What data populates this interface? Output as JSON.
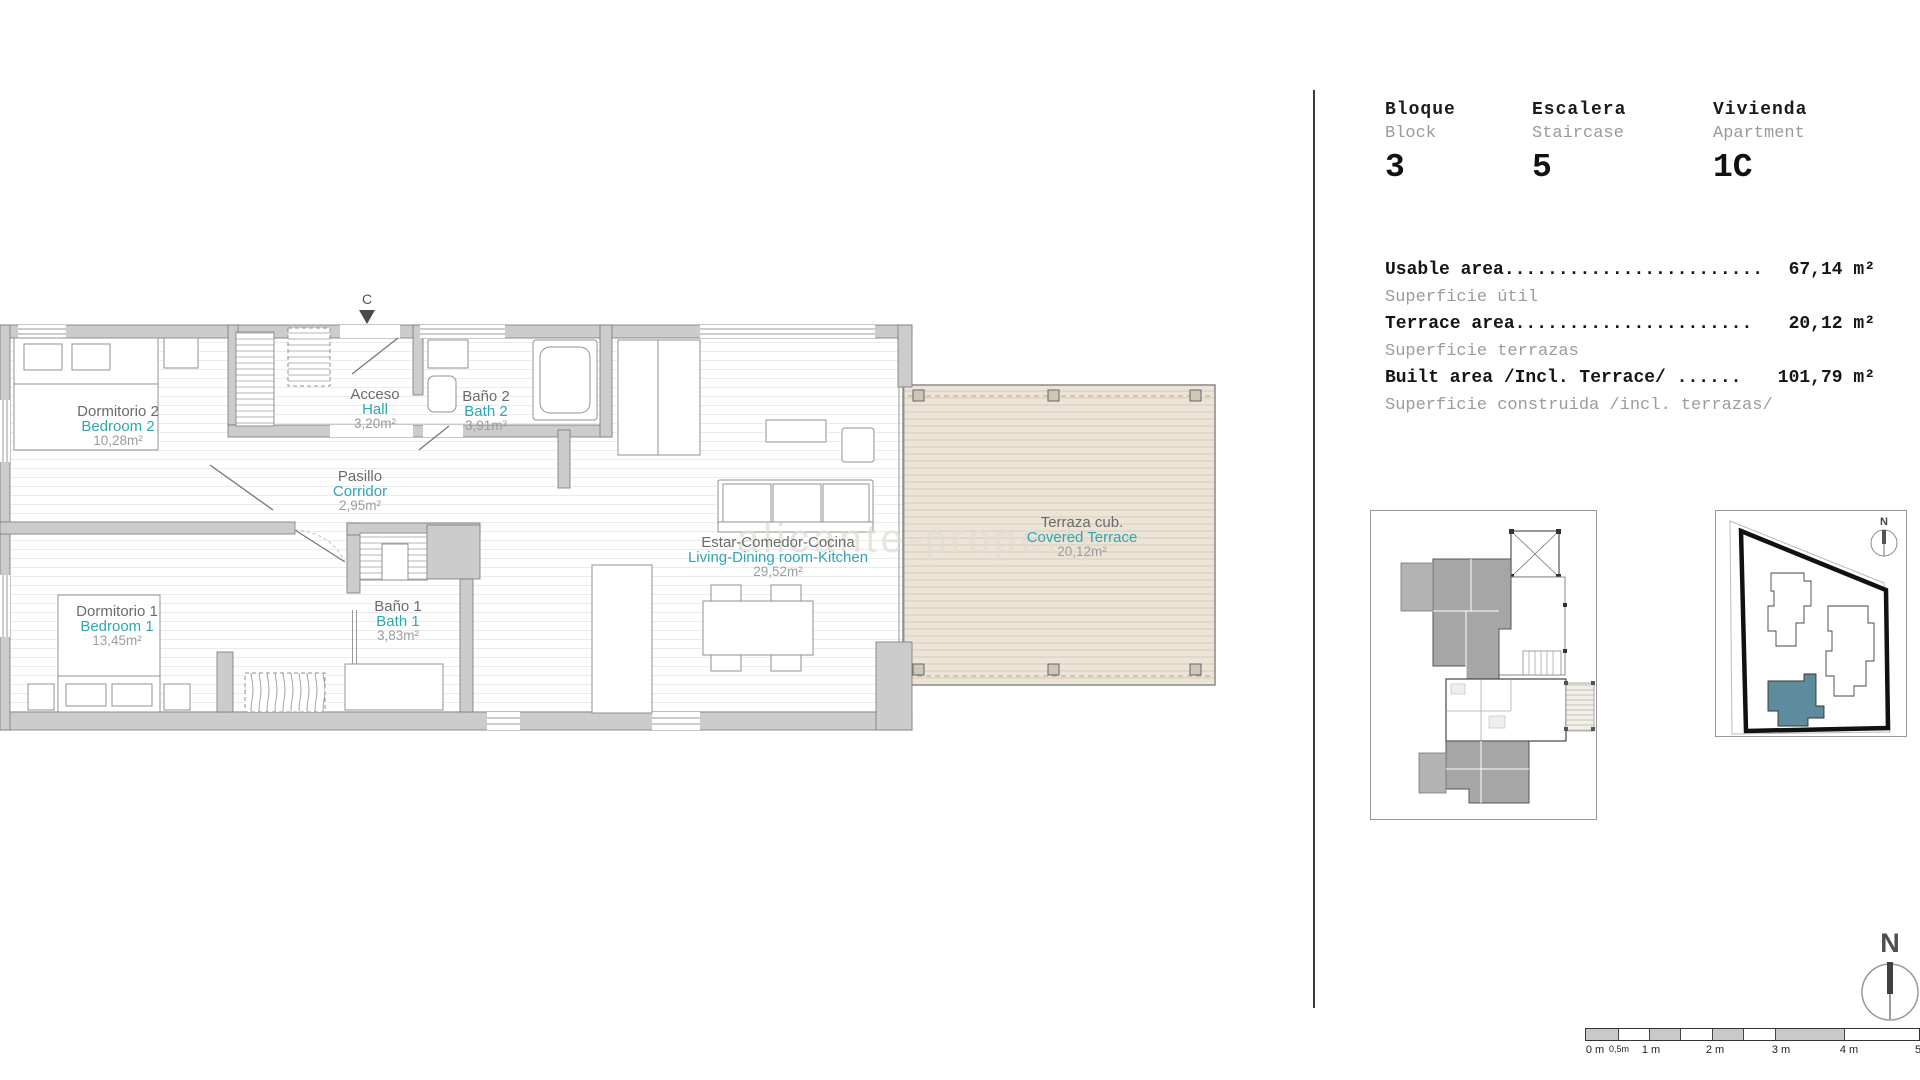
{
  "info_panel": {
    "columns": [
      {
        "es": "Bloque",
        "en": "Block",
        "value": "3"
      },
      {
        "es": "Escalera",
        "en": "Staircase",
        "value": "5"
      },
      {
        "es": "Vivienda",
        "en": "Apartment",
        "value": "1C"
      }
    ],
    "areas": [
      {
        "label": "Usable area",
        "dots": "........................",
        "value": "67,14 m²",
        "sub": "Superficie útil"
      },
      {
        "label": "Terrace area",
        "dots": "......................",
        "value": "20,12 m²",
        "sub": "Superficie terrazas"
      },
      {
        "label": "Built area /Incl. Terrace/ ",
        "dots": "......",
        "value": "101,79 m²",
        "sub": "Superficie construida /incl. terrazas/"
      }
    ]
  },
  "floor_plan": {
    "section_marker": "C",
    "watermark": "alicante-property",
    "rooms": [
      {
        "es": "Dormitorio 2",
        "en": "Bedroom 2",
        "area": "10,28m²"
      },
      {
        "es": "Acceso",
        "en": "Hall",
        "area": "3,20m²"
      },
      {
        "es": "Baño 2",
        "en": "Bath 2",
        "area": "3,91m²"
      },
      {
        "es": "Pasillo",
        "en": "Corridor",
        "area": "2,95m²"
      },
      {
        "es": "Dormitorio 1",
        "en": "Bedroom 1",
        "area": "13,45m²"
      },
      {
        "es": "Baño 1",
        "en": "Bath 1",
        "area": "3,83m²"
      },
      {
        "es": "Estar-Comedor-Cocina",
        "en": "Living-Dining room-Kitchen",
        "area": "29,52m²"
      },
      {
        "es": "Terraza cub.",
        "en": "Covered Terrace",
        "area": "20,12m²"
      }
    ]
  },
  "insets": {
    "compass_label": "N"
  },
  "scale_bar": {
    "labels": [
      "0 m",
      "0,5m",
      "1 m",
      "2 m",
      "3 m",
      "4 m",
      "5"
    ]
  },
  "colors": {
    "accent_teal_text": "#2fa6b4",
    "terrace_beige": "#ece4d6",
    "wall_gray": "#cccccc",
    "site_unit_teal": "#5d8c9c",
    "divider_dark": "#3a3a3a"
  }
}
